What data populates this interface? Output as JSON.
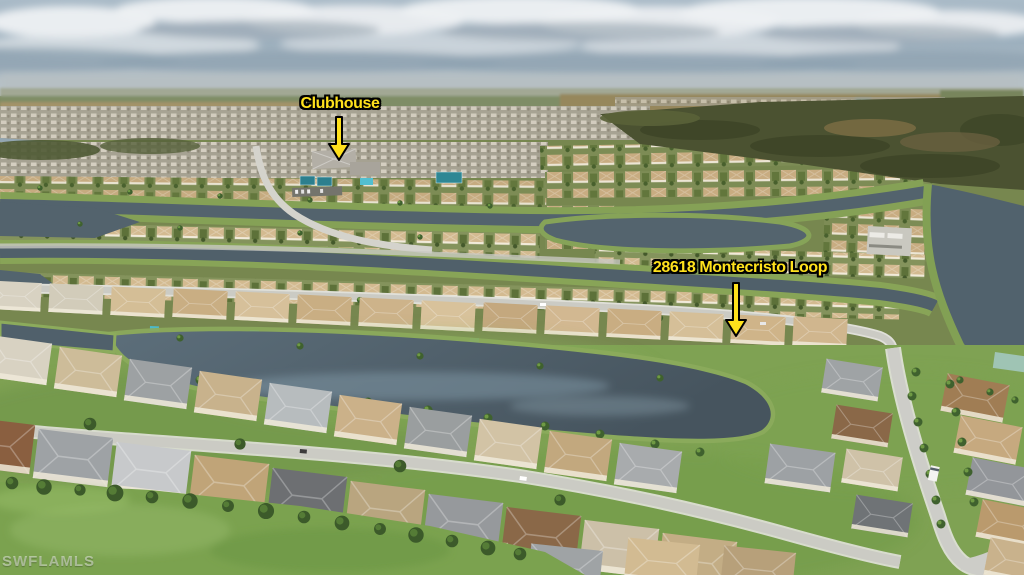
{
  "annotations": {
    "clubhouse": {
      "label": "Clubhouse"
    },
    "property": {
      "label": "28618 Montecristo Loop"
    },
    "style": {
      "text_color": "#FFE11C",
      "outline_color": "#000000",
      "arrow_color": "#FFE11C"
    }
  },
  "watermark": {
    "text": "SWFLAMLS"
  }
}
